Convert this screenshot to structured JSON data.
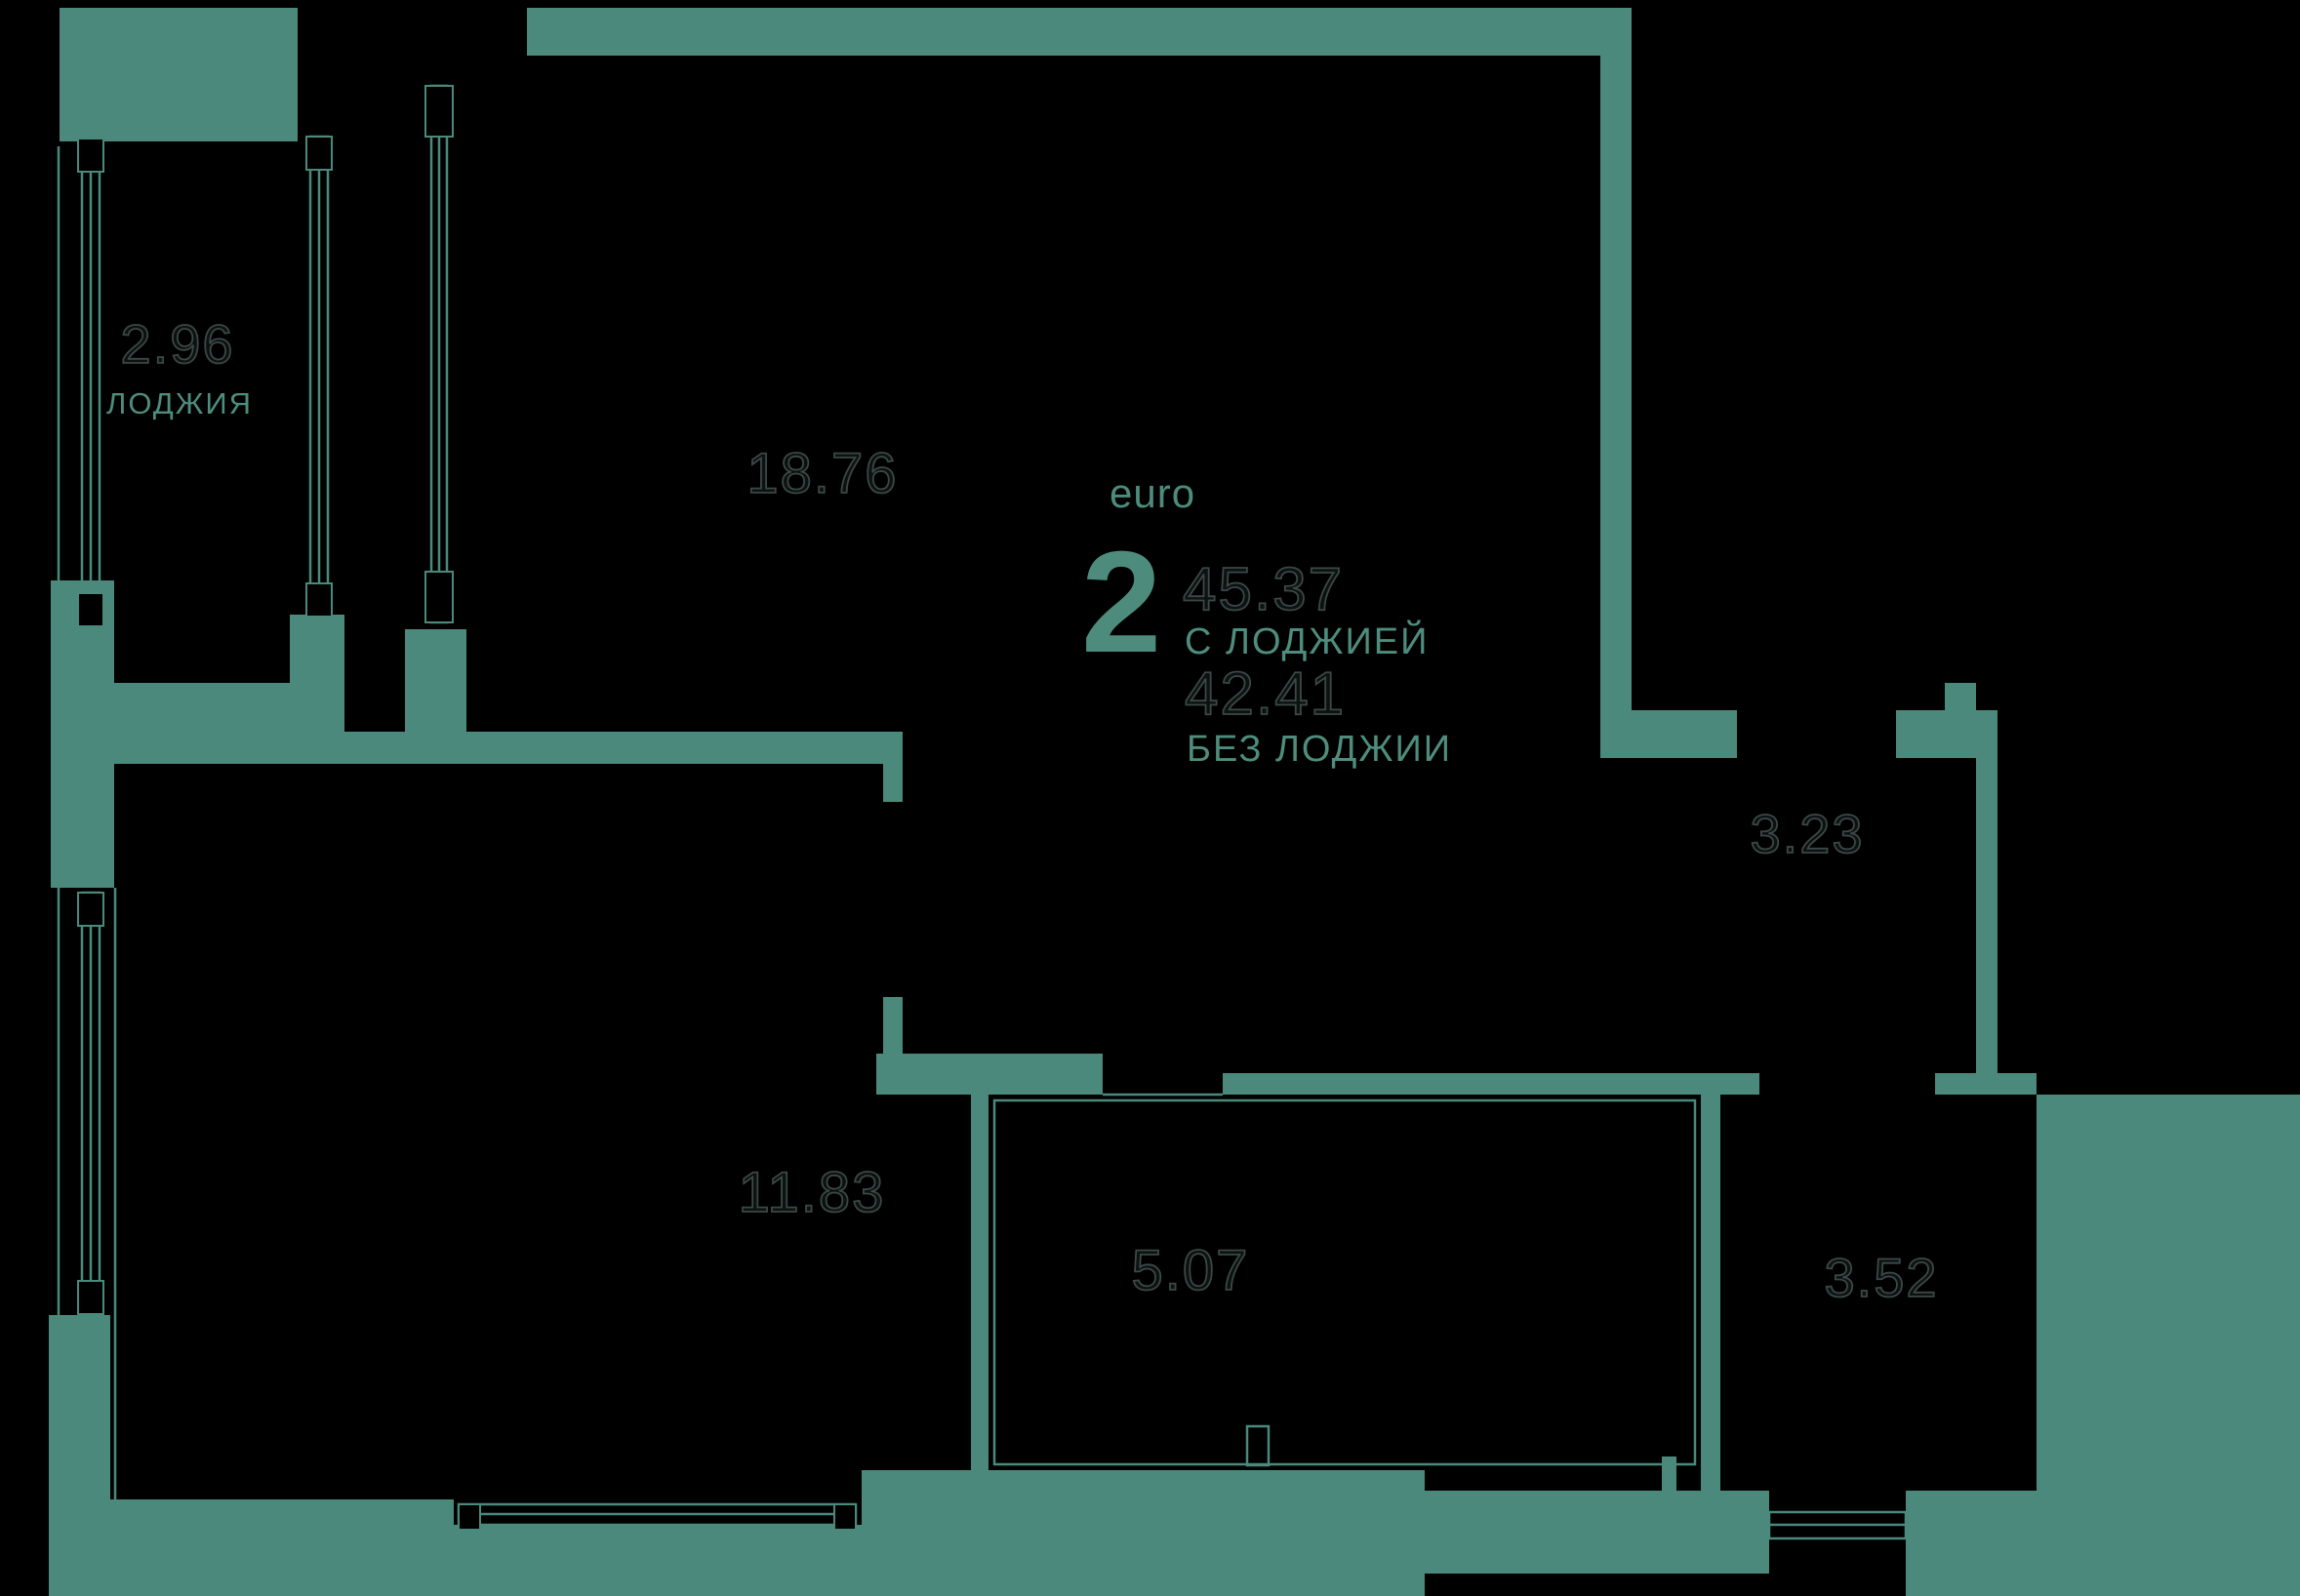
{
  "plan": {
    "title_block": {
      "unit_type_label": "euro",
      "rooms_count": "2",
      "area_with_loggia": "45.37",
      "with_loggia_label": "С ЛОДЖИЕЙ",
      "area_without_loggia": "42.41",
      "without_loggia_label": "БЕЗ ЛОДЖИИ"
    },
    "rooms": {
      "loggia": {
        "area": "2.96",
        "label": "ЛОДЖИЯ"
      },
      "living_kitchen": {
        "area": "18.76",
        "label": ""
      },
      "bedroom": {
        "area": "11.83",
        "label": ""
      },
      "bathroom": {
        "area": "5.07",
        "label": ""
      },
      "hallway": {
        "area": "3.23",
        "label": ""
      },
      "wardrobe": {
        "area": "3.52",
        "label": ""
      }
    },
    "colors": {
      "background": "#000000",
      "wall": "#4a897b",
      "accent_text": "#4d8c7c",
      "area_number_outline": "#3c4845"
    }
  }
}
